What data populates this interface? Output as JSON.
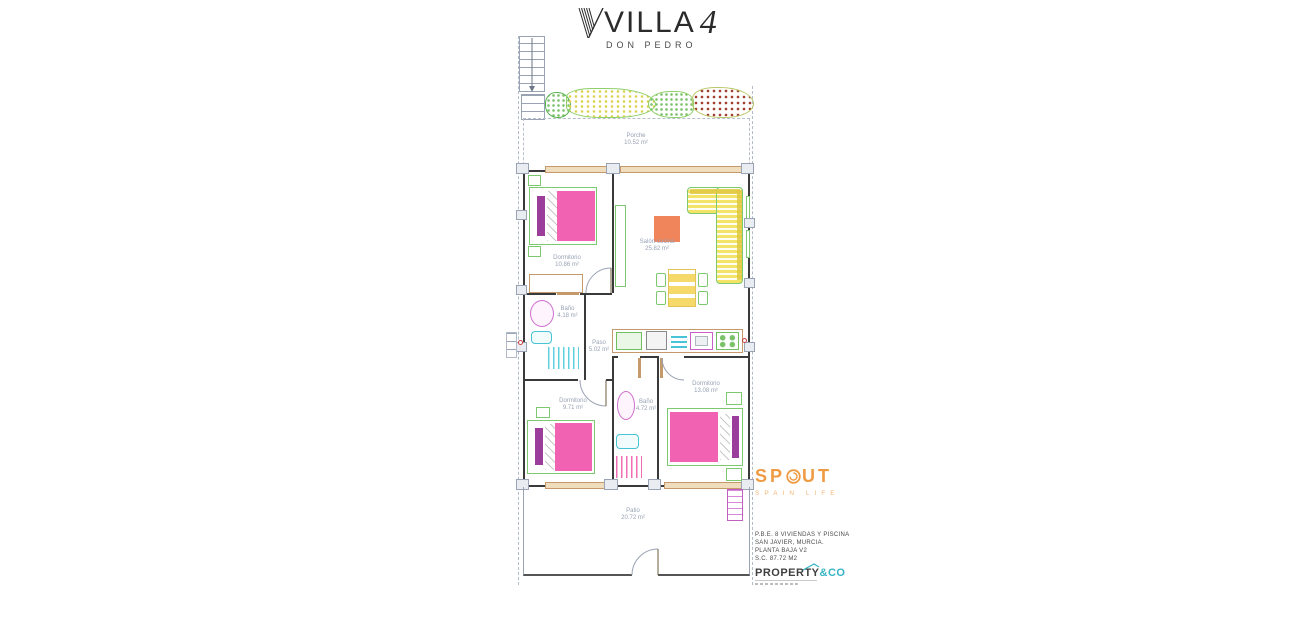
{
  "header": {
    "brand": "VILLA",
    "brand_number": "4",
    "brand_subtitle": "DON PEDRO"
  },
  "rooms": [
    {
      "name": "Porche",
      "area": "10.52 m²"
    },
    {
      "name": "Dormitorio",
      "area": "10.86 m²"
    },
    {
      "name": "Salón-cocina",
      "area": "25.82 m²"
    },
    {
      "name": "Baño",
      "area": "4.18 m²"
    },
    {
      "name": "Paso",
      "area": "5.02 m²"
    },
    {
      "name": "Dormitorio",
      "area": "9.71 m²"
    },
    {
      "name": "Baño",
      "area": "4.72 m²"
    },
    {
      "name": "Dormitorio",
      "area": "13.08 m²"
    },
    {
      "name": "Patio",
      "area": "20.72 m²"
    }
  ],
  "branding": {
    "spout": {
      "name": "SPOUT",
      "name_left": "SP",
      "name_right": "UT",
      "tagline": "SPAIN LIFE",
      "color": "#ef9b43"
    },
    "property_co": {
      "name": "PROPERTY",
      "suffix": "&CO",
      "accent": "#35b4c4"
    }
  },
  "project_info": {
    "lines": [
      "P.B.E. 8 VIVIENDAS Y PISCINA",
      "SAN JAVIER, MURCIA.",
      "PLANTA BAJA V2",
      "S.C. 87.72 M2"
    ]
  },
  "colors": {
    "bed_pink": "#f163b2",
    "pillow_purple": "#9b3d9b",
    "furniture_green": "#7cc96f",
    "sofa_yellow": "#f3e468",
    "table_orange": "#f0855c",
    "wood_tan": "#c49a6c",
    "fixture_cyan": "#49c3d6",
    "fixture_magenta": "#cf6fcf",
    "label_gray": "#98a2b3"
  }
}
